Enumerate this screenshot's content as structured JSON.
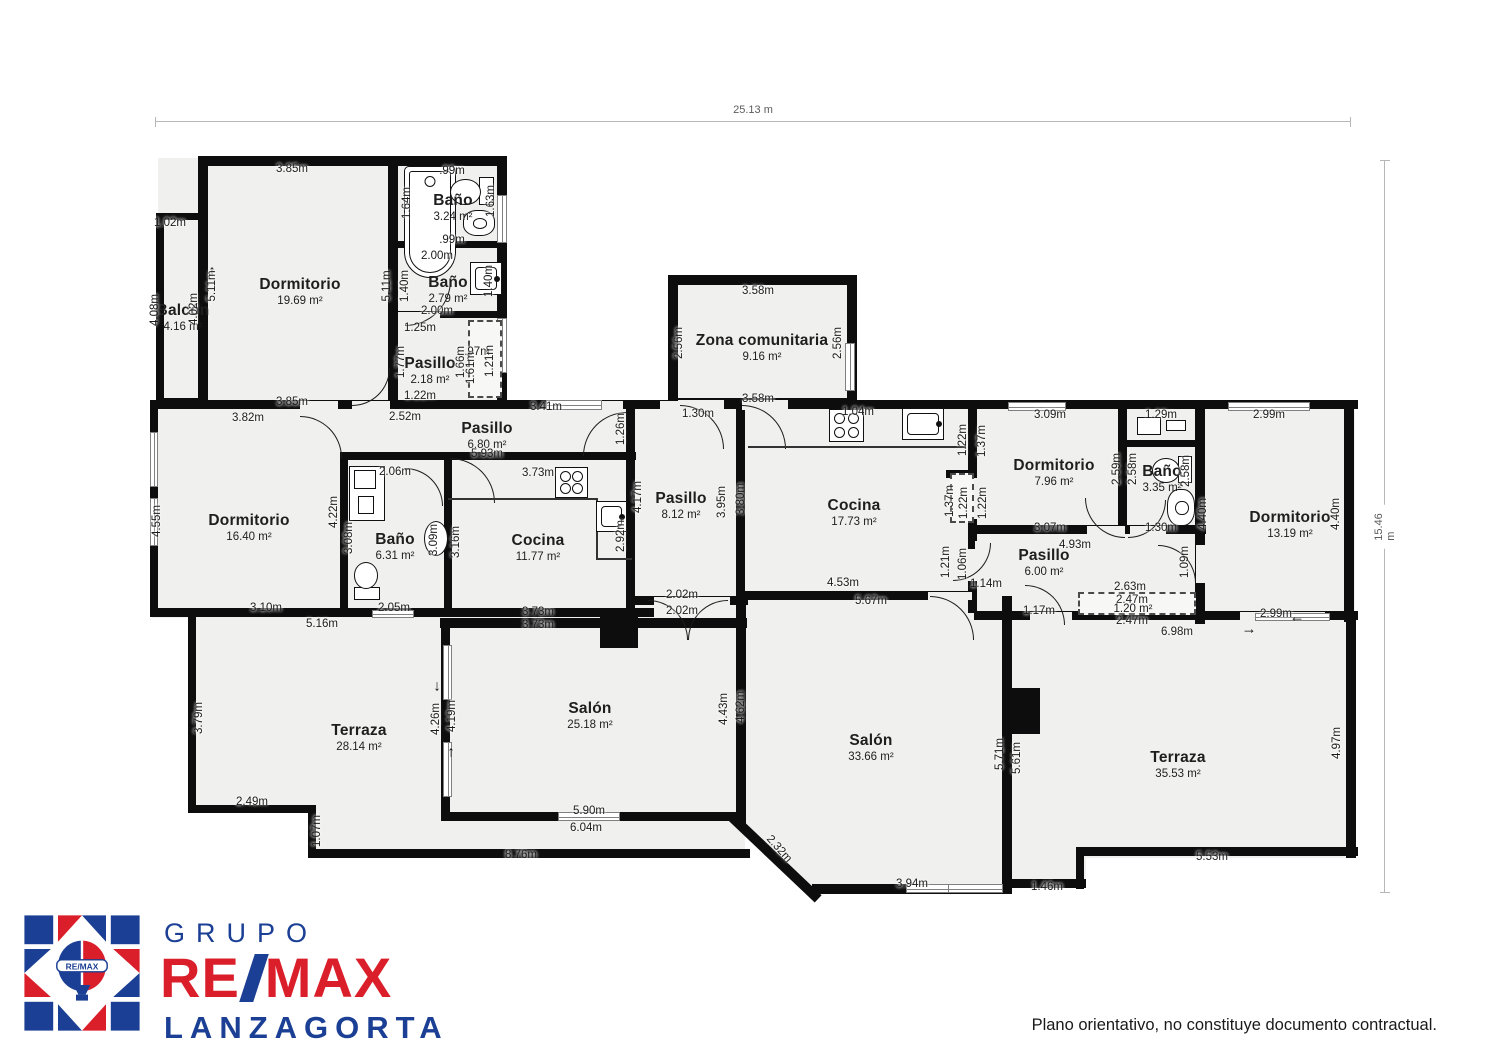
{
  "overall": {
    "width_label": "25.13 m",
    "height_label": "15.46 m"
  },
  "footer": {
    "disclaimer": "Plano orientativo, no constituye documento contractual."
  },
  "logo": {
    "line1": "GRUPO",
    "remax_re": "RE",
    "remax_max": "MAX",
    "line3": "LANZAGORTA",
    "badge": "RE/MAX",
    "red": "#da1f2b",
    "navy": "#1b3f94"
  },
  "rooms": [
    {
      "name": "Balcón",
      "area": "4.16 m²",
      "x": 183,
      "y": 318
    },
    {
      "name": "Dormitorio",
      "area": "19.69 m²",
      "x": 300,
      "y": 292
    },
    {
      "name": "Baño",
      "area": "3.24 m²",
      "x": 453,
      "y": 208
    },
    {
      "name": "Baño",
      "area": "2.79 m²",
      "x": 448,
      "y": 290
    },
    {
      "name": "Pasillo",
      "area": "2.18 m²",
      "x": 430,
      "y": 371
    },
    {
      "name": "Dormitorio",
      "area": "16.40 m²",
      "x": 249,
      "y": 528
    },
    {
      "name": "Baño",
      "area": "6.31 m²",
      "x": 395,
      "y": 547
    },
    {
      "name": "Pasillo",
      "area": "6.80 m²",
      "x": 487,
      "y": 436
    },
    {
      "name": "Cocina",
      "area": "11.77 m²",
      "x": 538,
      "y": 548
    },
    {
      "name": "Pasillo",
      "area": "8.12 m²",
      "x": 681,
      "y": 506
    },
    {
      "name": "Zona comunitaria",
      "area": "9.16 m²",
      "x": 762,
      "y": 348
    },
    {
      "name": "Cocina",
      "area": "17.73 m²",
      "x": 854,
      "y": 513
    },
    {
      "name": "Dormitorio",
      "area": "7.96 m²",
      "x": 1054,
      "y": 473
    },
    {
      "name": "Baño",
      "area": "3.35 m²",
      "x": 1162,
      "y": 479
    },
    {
      "name": "Dormitorio",
      "area": "13.19 m²",
      "x": 1290,
      "y": 525
    },
    {
      "name": "Pasillo",
      "area": "6.00 m²",
      "x": 1044,
      "y": 563
    },
    {
      "name": "Terraza",
      "area": "28.14 m²",
      "x": 359,
      "y": 738
    },
    {
      "name": "Salón",
      "area": "25.18 m²",
      "x": 590,
      "y": 716
    },
    {
      "name": "Salón",
      "area": "33.66 m²",
      "x": 871,
      "y": 748
    },
    {
      "name": "Terraza",
      "area": "35.53 m²",
      "x": 1178,
      "y": 765
    }
  ],
  "dims": [
    [
      "3.85m",
      292,
      169,
      0
    ],
    [
      ".99m",
      452,
      171,
      0
    ],
    [
      "1.64m",
      407,
      203,
      -90
    ],
    [
      "1.63m",
      491,
      201,
      -90
    ],
    [
      ".99m",
      452,
      240,
      0
    ],
    [
      "2.00m",
      437,
      256,
      0
    ],
    [
      "1.40m",
      405,
      286,
      -90
    ],
    [
      "1.40m",
      489,
      281,
      -90
    ],
    [
      "2.00m",
      437,
      311,
      0
    ],
    [
      "1.25m",
      420,
      328,
      0
    ],
    [
      "1.77m",
      401,
      362,
      -90
    ],
    [
      "1.66m",
      461,
      362,
      -90
    ],
    [
      ".97m",
      477,
      352,
      0
    ],
    [
      "1.61m",
      471,
      368,
      -90
    ],
    [
      "1.21m",
      490,
      361,
      -90
    ],
    [
      "1.22m",
      420,
      396,
      0
    ],
    [
      "1.02m",
      170,
      223,
      0
    ],
    [
      "4.08m",
      155,
      310,
      -90
    ],
    [
      "4.02m",
      194,
      309,
      -90
    ],
    [
      "5.11m",
      212,
      286,
      -90
    ],
    [
      "5.11m",
      387,
      286,
      -90
    ],
    [
      "3.85m",
      292,
      402,
      0
    ],
    [
      "3.82m",
      248,
      418,
      0
    ],
    [
      "2.52m",
      405,
      417,
      0
    ],
    [
      "4.55m",
      157,
      521,
      -90
    ],
    [
      "4.22m",
      334,
      512,
      -90
    ],
    [
      "2.06m",
      395,
      472,
      0
    ],
    [
      "3.08m",
      349,
      538,
      -90
    ],
    [
      "3.09m",
      434,
      540,
      -90
    ],
    [
      "3.16m",
      456,
      542,
      -90
    ],
    [
      "3.10m",
      266,
      608,
      0
    ],
    [
      "2.05m",
      394,
      608,
      0
    ],
    [
      "5.16m",
      322,
      624,
      0
    ],
    [
      "3.41m",
      546,
      407,
      0
    ],
    [
      "5.93m",
      487,
      454,
      0
    ],
    [
      "1.26m",
      621,
      429,
      -90
    ],
    [
      "3.73m",
      538,
      473,
      0
    ],
    [
      "2.92m",
      621,
      536,
      -90
    ],
    [
      "3.73m",
      538,
      612,
      0
    ],
    [
      "3.73m",
      538,
      625,
      0
    ],
    [
      "4.17m",
      638,
      497,
      -90
    ],
    [
      "3.95m",
      722,
      502,
      -90
    ],
    [
      "3.80m",
      741,
      499,
      -90
    ],
    [
      "2.02m",
      682,
      595,
      0
    ],
    [
      "2.02m",
      682,
      611,
      0
    ],
    [
      "1.30m",
      698,
      414,
      0
    ],
    [
      "3.58m",
      758,
      291,
      0
    ],
    [
      "2.56m",
      679,
      343,
      -90
    ],
    [
      "2.56m",
      838,
      343,
      -90
    ],
    [
      "3.58m",
      758,
      399,
      0
    ],
    [
      "1.04m",
      858,
      412,
      0
    ],
    [
      "1.22m",
      963,
      440,
      -90
    ],
    [
      "1.37m",
      982,
      441,
      -90
    ],
    [
      "1.37m",
      950,
      501,
      -90
    ],
    [
      "1.22m",
      964,
      503,
      -90
    ],
    [
      "1.22m",
      983,
      503,
      -90
    ],
    [
      "4.53m",
      843,
      583,
      0
    ],
    [
      "5.67m",
      871,
      601,
      0
    ],
    [
      "1.21m",
      946,
      562,
      -90
    ],
    [
      "1.06m",
      963,
      564,
      -90
    ],
    [
      "1.14m",
      986,
      584,
      0
    ],
    [
      "3.09m",
      1050,
      415,
      0
    ],
    [
      "2.59m",
      1117,
      469,
      -90
    ],
    [
      "3.07m",
      1050,
      528,
      0
    ],
    [
      "4.93m",
      1075,
      545,
      0
    ],
    [
      "1.29m",
      1161,
      415,
      0
    ],
    [
      "2.58m",
      1133,
      469,
      -90
    ],
    [
      "2.58m",
      1186,
      471,
      -90
    ],
    [
      "1.30m",
      1161,
      528,
      0
    ],
    [
      "2.99m",
      1269,
      415,
      0
    ],
    [
      "4.40m",
      1203,
      514,
      -90
    ],
    [
      "4.40m",
      1336,
      514,
      -90
    ],
    [
      "2.99m",
      1276,
      614,
      0
    ],
    [
      "1.09m",
      1185,
      562,
      -90
    ],
    [
      "1.17m",
      1039,
      611,
      0
    ],
    [
      "2.63m",
      1130,
      587,
      0
    ],
    [
      "2.47m",
      1132,
      600,
      0
    ],
    [
      "1.20 m²",
      1133,
      609,
      0
    ],
    [
      "2.47m",
      1132,
      621,
      0
    ],
    [
      "6.98m",
      1177,
      632,
      0
    ],
    [
      "3.79m",
      199,
      718,
      -90
    ],
    [
      "2.49m",
      252,
      802,
      0
    ],
    [
      "1.07m",
      317,
      831,
      -90
    ],
    [
      "8.76m",
      521,
      855,
      0
    ],
    [
      "4.26m",
      436,
      719,
      -90
    ],
    [
      "4.19m",
      452,
      716,
      -90
    ],
    [
      "5.90m",
      589,
      811,
      0
    ],
    [
      "6.04m",
      586,
      828,
      0
    ],
    [
      "4.43m",
      724,
      709,
      -90
    ],
    [
      "4.62m",
      741,
      707,
      -90
    ],
    [
      "5.71m",
      1000,
      754,
      -90
    ],
    [
      "5.61m",
      1017,
      758,
      -90
    ],
    [
      "2.32m",
      779,
      849,
      48
    ],
    [
      "3.94m",
      912,
      884,
      0
    ],
    [
      "1.46m",
      1047,
      887,
      0
    ],
    [
      "4.97m",
      1337,
      743,
      -90
    ],
    [
      "5.53m",
      1212,
      857,
      0
    ]
  ],
  "floorplan": {
    "fills": [
      [
        158,
        158,
        347,
        250
      ],
      [
        152,
        402,
        593,
        216
      ],
      [
        670,
        277,
        185,
        131
      ],
      [
        740,
        402,
        235,
        200
      ],
      [
        975,
        402,
        380,
        220
      ],
      [
        190,
        615,
        555,
        196
      ],
      [
        312,
        806,
        433,
        47
      ],
      [
        738,
        598,
        274,
        294,
        "polygon(0 0,100% 0,100% 100%,28% 100%,0 75%)"
      ],
      [
        1012,
        618,
        340,
        240
      ],
      [
        1012,
        855,
        74,
        30
      ]
    ],
    "walls": [
      [
        198,
        156,
        309,
        10
      ],
      [
        156,
        213,
        8,
        192
      ],
      [
        156,
        213,
        50,
        7
      ],
      [
        156,
        398,
        50,
        7
      ],
      [
        198,
        156,
        10,
        252
      ],
      [
        388,
        156,
        10,
        250
      ],
      [
        497,
        156,
        10,
        252
      ],
      [
        392,
        241,
        110,
        7
      ],
      [
        392,
        311,
        110,
        7
      ],
      [
        150,
        400,
        600,
        9
      ],
      [
        668,
        275,
        189,
        10
      ],
      [
        668,
        275,
        10,
        133
      ],
      [
        847,
        275,
        10,
        133
      ],
      [
        668,
        398,
        189,
        9
      ],
      [
        738,
        400,
        240,
        9
      ],
      [
        968,
        400,
        390,
        9
      ],
      [
        150,
        400,
        8,
        217
      ],
      [
        342,
        452,
        110,
        8
      ],
      [
        340,
        452,
        8,
        162
      ],
      [
        444,
        452,
        8,
        162
      ],
      [
        444,
        452,
        192,
        8
      ],
      [
        626,
        400,
        9,
        210
      ],
      [
        150,
        608,
        504,
        9
      ],
      [
        736,
        400,
        9,
        206
      ],
      [
        628,
        596,
        120,
        9
      ],
      [
        968,
        400,
        9,
        78
      ],
      [
        946,
        470,
        30,
        8
      ],
      [
        968,
        519,
        9,
        30
      ],
      [
        968,
        581,
        9,
        32
      ],
      [
        738,
        591,
        238,
        9
      ],
      [
        974,
        525,
        232,
        9
      ],
      [
        1118,
        400,
        9,
        134
      ],
      [
        1195,
        400,
        10,
        224
      ],
      [
        1126,
        440,
        73,
        7
      ],
      [
        1344,
        400,
        10,
        222
      ],
      [
        974,
        611,
        384,
        9
      ],
      [
        188,
        613,
        8,
        200
      ],
      [
        188,
        805,
        128,
        8
      ],
      [
        308,
        805,
        8,
        53
      ],
      [
        308,
        849,
        442,
        9
      ],
      [
        440,
        618,
        307,
        10
      ],
      [
        441,
        618,
        9,
        203
      ],
      [
        441,
        812,
        302,
        9
      ],
      [
        736,
        596,
        10,
        228
      ],
      [
        812,
        884,
        200,
        10
      ],
      [
        1002,
        596,
        10,
        292
      ],
      [
        1076,
        847,
        8,
        42
      ],
      [
        1080,
        847,
        278,
        9
      ],
      [
        1346,
        611,
        10,
        247
      ],
      [
        1006,
        879,
        80,
        9
      ],
      [
        736,
        814,
        118,
        10,
        43.5
      ]
    ],
    "gaps": [
      [
        678,
        400,
        46,
        10
      ],
      [
        742,
        400,
        46,
        10
      ],
      [
        654,
        597,
        76,
        8
      ],
      [
        928,
        592,
        44,
        8
      ],
      [
        975,
        541,
        8,
        40
      ],
      [
        1087,
        526,
        38,
        8
      ],
      [
        1130,
        526,
        36,
        8
      ],
      [
        1196,
        545,
        9,
        38
      ],
      [
        1030,
        612,
        42,
        8
      ],
      [
        1240,
        612,
        85,
        8
      ],
      [
        398,
        312,
        42,
        6
      ],
      [
        352,
        401,
        38,
        8
      ],
      [
        300,
        401,
        38,
        8
      ],
      [
        583,
        401,
        40,
        8
      ],
      [
        660,
        401,
        44,
        8
      ]
    ],
    "pillars": [
      [
        600,
        616,
        38,
        32
      ],
      [
        1008,
        688,
        32,
        46
      ]
    ],
    "windows": [
      [
        497,
        195,
        10,
        48
      ],
      [
        497,
        318,
        10,
        55
      ],
      [
        150,
        432,
        8,
        55
      ],
      [
        150,
        498,
        8,
        48
      ],
      [
        546,
        400,
        56,
        10
      ],
      [
        845,
        343,
        10,
        48
      ],
      [
        1008,
        402,
        58,
        9
      ],
      [
        1228,
        402,
        82,
        9
      ],
      [
        443,
        645,
        9,
        55
      ],
      [
        443,
        742,
        9,
        55
      ],
      [
        558,
        812,
        62,
        9
      ],
      [
        906,
        884,
        70,
        9
      ],
      [
        948,
        884,
        55,
        9
      ],
      [
        372,
        610,
        42,
        8
      ],
      [
        1255,
        613,
        75,
        8
      ]
    ],
    "doors": [
      [
        352,
        368,
        38,
        "br"
      ],
      [
        300,
        416,
        42,
        "tr"
      ],
      [
        405,
        280,
        46,
        "br"
      ],
      [
        450,
        458,
        45,
        "tr"
      ],
      [
        583,
        412,
        44,
        "tl"
      ],
      [
        680,
        405,
        44,
        "tr"
      ],
      [
        742,
        405,
        44,
        "tr"
      ],
      [
        648,
        600,
        40,
        "tr"
      ],
      [
        688,
        600,
        40,
        "tl"
      ],
      [
        930,
        596,
        44,
        "tr"
      ],
      [
        953,
        543,
        38,
        "br"
      ],
      [
        1085,
        498,
        40,
        "bl"
      ],
      [
        1128,
        500,
        38,
        "br"
      ],
      [
        1158,
        545,
        38,
        "tr"
      ],
      [
        1025,
        585,
        40,
        "tr"
      ],
      [
        405,
        468,
        38,
        "tr"
      ]
    ],
    "closets": [
      [
        468,
        320,
        34,
        78
      ],
      [
        950,
        473,
        24,
        50
      ],
      [
        1078,
        592,
        118,
        23
      ]
    ],
    "fixtures": [
      [
        "tub",
        404,
        166,
        52,
        112,
        0
      ],
      [
        "wc",
        450,
        177,
        44,
        28,
        0
      ],
      [
        "bidet",
        463,
        210,
        32,
        26,
        0
      ],
      [
        "sink",
        470,
        262,
        32,
        33,
        0
      ],
      [
        "vanity",
        349,
        466,
        36,
        55,
        0
      ],
      [
        "wc",
        348,
        568,
        38,
        26,
        90
      ],
      [
        "oval",
        424,
        521,
        24,
        35,
        0
      ],
      [
        "stove",
        555,
        467,
        33,
        31,
        0
      ],
      [
        "sink",
        596,
        501,
        31,
        31,
        0
      ],
      [
        "stove",
        829,
        409,
        35,
        33,
        0
      ],
      [
        "sink",
        902,
        408,
        42,
        32,
        0
      ],
      [
        "box",
        1137,
        417,
        24,
        18,
        0
      ],
      [
        "box",
        1166,
        420,
        20,
        11,
        0
      ],
      [
        "wc",
        1152,
        456,
        40,
        27,
        0
      ],
      [
        "bidet",
        1167,
        489,
        28,
        37,
        0
      ]
    ],
    "lines": [
      [
        448,
        498,
        150,
        2
      ],
      [
        596,
        498,
        2,
        62
      ],
      [
        598,
        558,
        34,
        2
      ],
      [
        748,
        446,
        218,
        2
      ]
    ],
    "arrows": [
      [
        202,
        236,
        "↓"
      ],
      [
        212,
        271,
        "↑"
      ],
      [
        437,
        686,
        "↓"
      ],
      [
        451,
        752,
        "↑"
      ],
      [
        1297,
        617,
        "←"
      ],
      [
        1249,
        629,
        "→"
      ]
    ]
  }
}
